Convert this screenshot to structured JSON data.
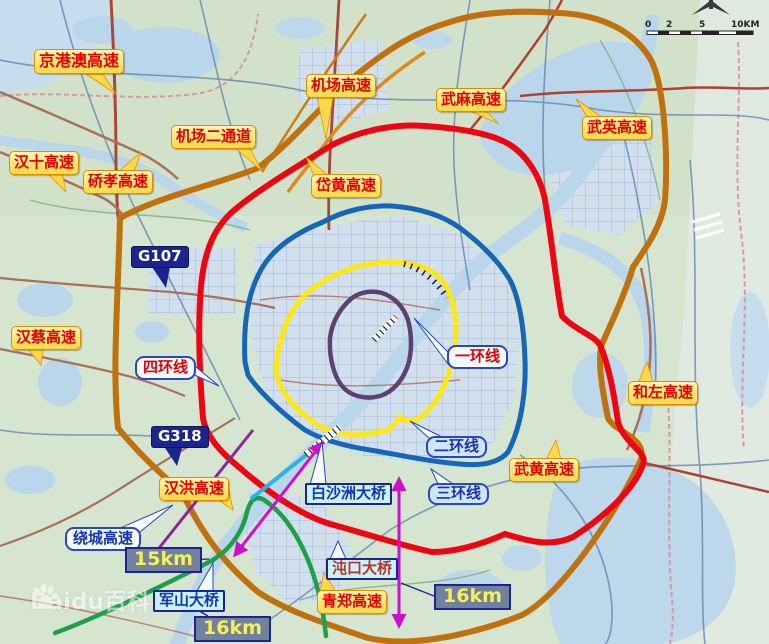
{
  "rings": [
    {
      "name": "一环线",
      "color": "#5c4270"
    },
    {
      "name": "二环线",
      "color": "#ffe712"
    },
    {
      "name": "三环线",
      "color": "#1565b8"
    },
    {
      "name": "四环线",
      "color": "#ee0511"
    }
  ],
  "ring_expressway": {
    "name": "绕城高速",
    "color": "#c0700c"
  },
  "expressways": [
    {
      "name": "京港澳高速"
    },
    {
      "name": "汉十高速"
    },
    {
      "name": "硚孝高速"
    },
    {
      "name": "机场二通道"
    },
    {
      "name": "机场高速"
    },
    {
      "name": "岱黄高速"
    },
    {
      "name": "武麻高速"
    },
    {
      "name": "武英高速"
    },
    {
      "name": "汉蔡高速"
    },
    {
      "name": "和左高速"
    },
    {
      "name": "汉洪高速"
    },
    {
      "name": "武黄高速"
    },
    {
      "name": "青郑高速"
    }
  ],
  "national_roads": [
    {
      "name": "G107"
    },
    {
      "name": "G318"
    }
  ],
  "bridges": [
    {
      "name": "白沙洲大桥"
    },
    {
      "name": "沌口大桥"
    },
    {
      "name": "军山大桥"
    }
  ],
  "distance_markers": [
    {
      "value": "15km"
    },
    {
      "value": "16km"
    },
    {
      "value": "16km"
    }
  ],
  "scale_bar": {
    "ticks": [
      "0",
      "2",
      "5",
      "10KM"
    ]
  },
  "watermark": {
    "text": "Baidu百科"
  },
  "map_colors": {
    "river": "#b9d6ea",
    "land": "#d5e5d0",
    "green_expressway": "#1fa048",
    "measure_arrow": "#cc10cc"
  }
}
